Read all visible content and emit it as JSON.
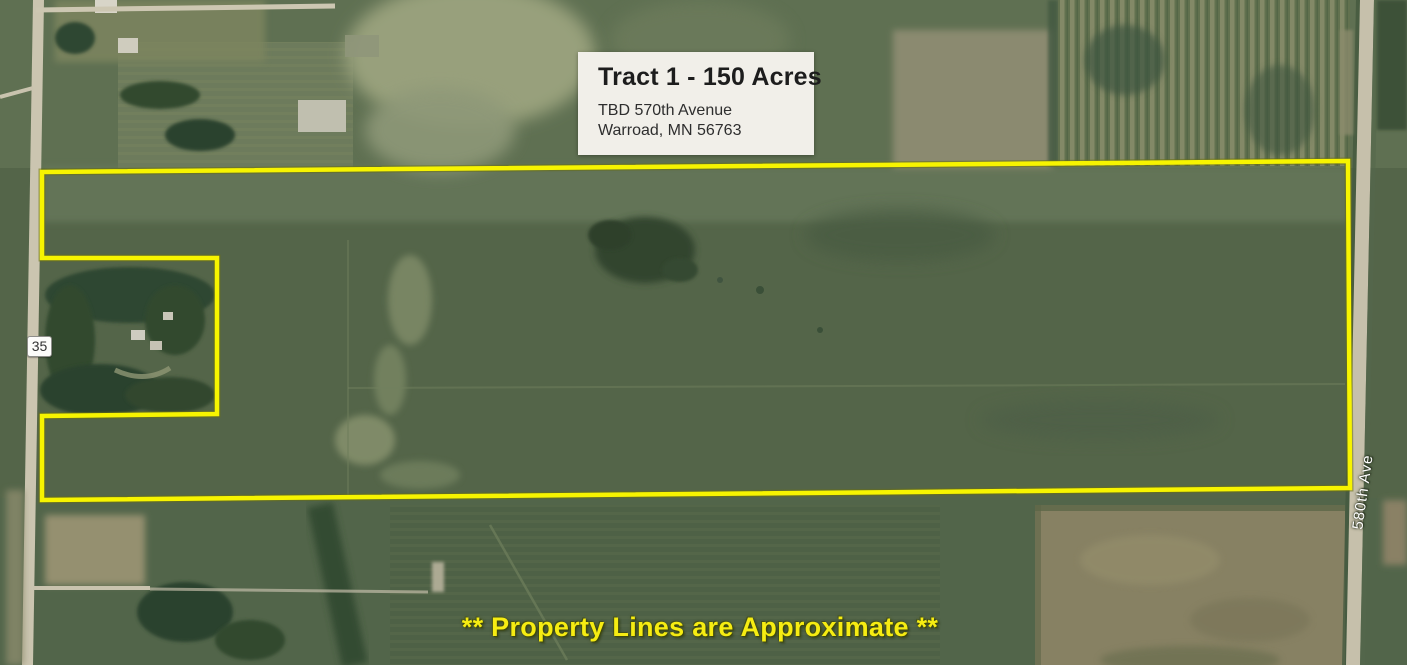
{
  "info_card": {
    "title": "Tract 1 - 150 Acres",
    "address_line1": "TBD 570th Avenue",
    "address_line2": "Warroad, MN 56763"
  },
  "labels": {
    "route_marker": "35",
    "road_label": "580th Ave",
    "disclaimer": "** Property Lines are Approximate **"
  },
  "colors": {
    "boundary_yellow": "#f7f400",
    "disclaimer_yellow": "#f6ec12",
    "road_label_white": "#ffffff"
  }
}
